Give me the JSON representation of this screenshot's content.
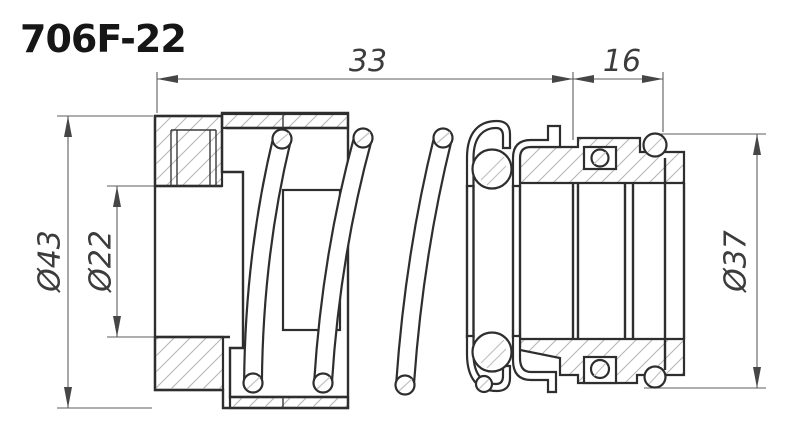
{
  "title": "706F-22",
  "dimensions": {
    "top_width": "33",
    "top_right_width": "16",
    "left_outer_diameter": "Ø43",
    "left_bore_diameter": "Ø22",
    "right_outer_diameter": "Ø37"
  }
}
